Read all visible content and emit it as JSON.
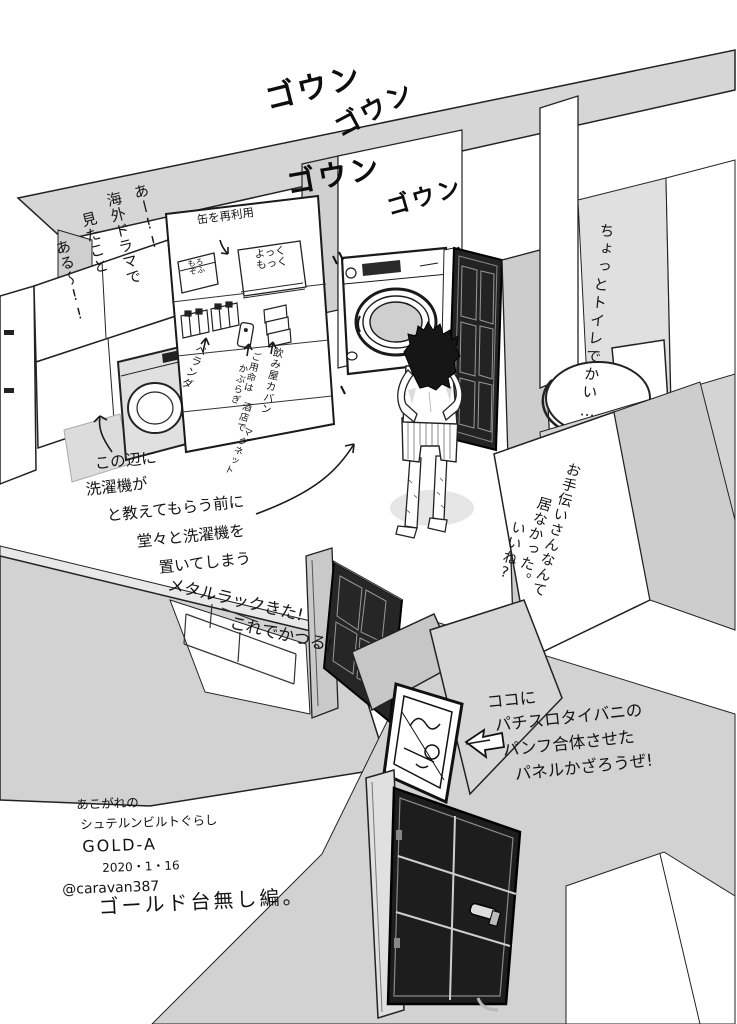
{
  "artwork": {
    "credit_lines": [
      "あこがれの",
      "シュテルンビルトぐらし",
      "GOLD-A",
      "2020・1・16",
      "@caravan387"
    ],
    "episode_title": "ゴールド台無し編。"
  },
  "sfx": {
    "washer_sound": [
      "ゴウン",
      "ゴウン",
      "ゴウン",
      "ゴウン"
    ]
  },
  "notes": {
    "overseas_drama": [
      "あー!!",
      "海外ドラマで",
      "見たこと",
      "ある〜!!"
    ],
    "toilet_size": "ちょっとトイレでかい…",
    "no_maid": [
      "お手伝いさんなんて",
      "居なかった。",
      "いいね?"
    ],
    "washer_placement": [
      "この辺に",
      "洗濯機が",
      "と教えてもらう前に",
      "堂々と洗濯機を",
      "置いてしまう"
    ],
    "metal_rack": [
      "メタルラックきた!",
      "これでかつる!"
    ],
    "panel_display": [
      "ココに",
      "パチスロタイバニの",
      "パンフ合体させた",
      "パネルかざろうぜ!"
    ]
  },
  "labels": {
    "reuse_cans": "缶を再利用",
    "tin_morozofu": [
      "もろ",
      "ぞふ"
    ],
    "tin_yokkumokku": [
      "よっく",
      "もっく"
    ],
    "balcony": "ベランダ",
    "izakaya_bag": "飲み屋カバン",
    "liquor_magnet": [
      "ご用命は",
      "かぶらぎ",
      "酒店で",
      "マグネット"
    ]
  },
  "colors": {
    "wall_gray": "#d2d2d2",
    "floor_white": "#ffffff",
    "door_dark": "#1d1d1d",
    "ink": "#1a1a1a",
    "drum_gray": "#cfcfcf"
  }
}
